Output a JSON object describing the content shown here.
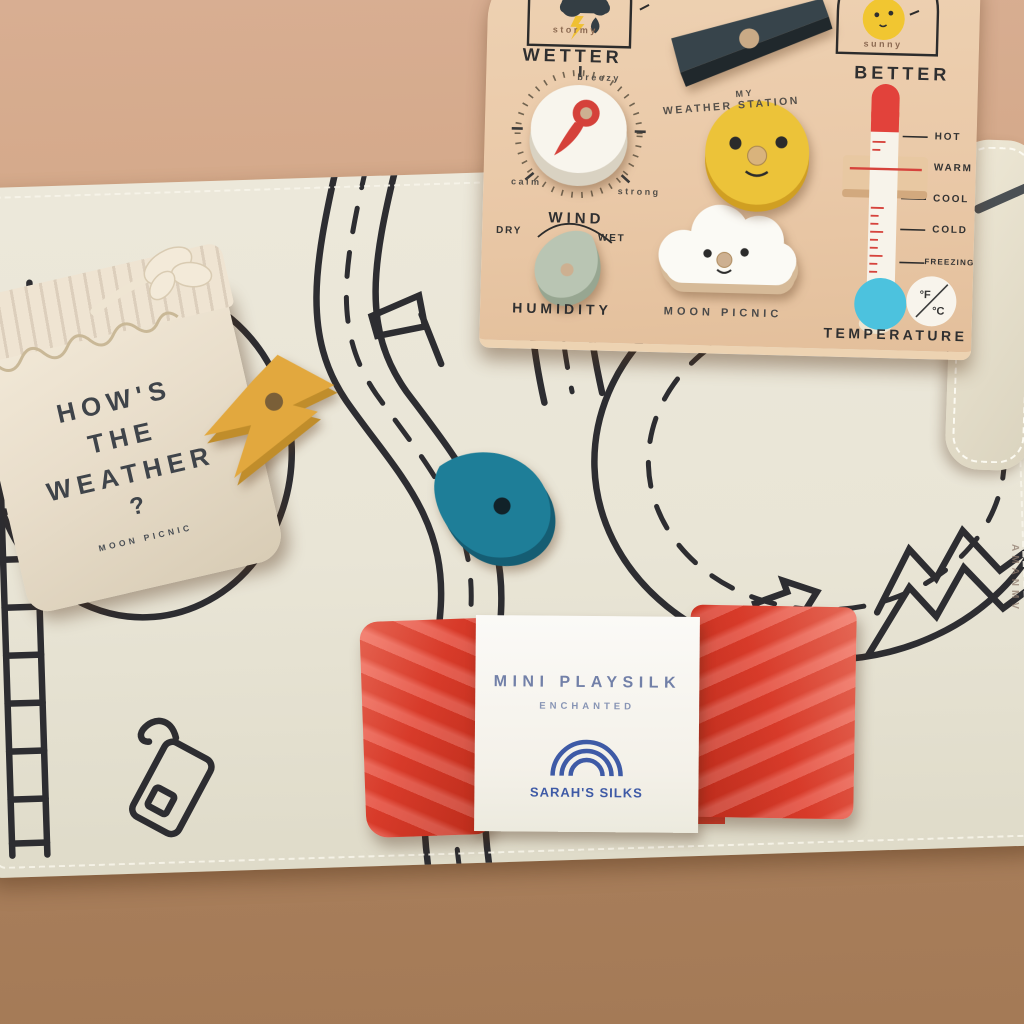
{
  "board": {
    "heading_left": "WETTER",
    "heading_right": "BETTER",
    "caption_stormy": "stormy",
    "caption_sunny": "sunny",
    "station_line1": "MY",
    "station_line2": "WEATHER STATION",
    "brand": "MOON PICNIC",
    "wind": {
      "label": "WIND",
      "top": "breezy",
      "bottom_left": "calm",
      "bottom_right": "strong"
    },
    "humidity": {
      "label": "HUMIDITY",
      "left": "DRY",
      "right": "WET"
    },
    "temperature": {
      "label": "TEMPERATURE",
      "scale": {
        "hot": "HOT",
        "warm": "WARM",
        "cool": "COOL",
        "cold": "COLD",
        "freezing": "FREEZING"
      },
      "unit_f": "°F",
      "unit_c": "°C"
    }
  },
  "bag": {
    "line1": "HOW'S",
    "line2": "THE",
    "line3": "WEATHER",
    "line4": "?",
    "brand": "MOON PICNIC"
  },
  "silk_label": {
    "title": "MINI PLAYSILK",
    "subtitle": "ENCHANTED",
    "brand": "SARAH'S SILKS"
  },
  "mat": {
    "embossed_text": "AMANMV"
  },
  "colors": {
    "board_wood": "#eac9a8",
    "navy_piece": "#37444b",
    "sun_yellow": "#ecc339",
    "bolt_yellow": "#e2a83e",
    "pin_red": "#d5413a",
    "thermo_red": "#e2423b",
    "bulb_blue": "#4cc2de",
    "sage_green": "#b9c5b3",
    "teal_drop": "#1e7e98",
    "silk_red": "#e2402f",
    "label_blue": "#3e5aa6",
    "mat_cream": "#eae6d7",
    "bag_cream": "#ece1d0",
    "road_ink": "#2d2d31"
  }
}
